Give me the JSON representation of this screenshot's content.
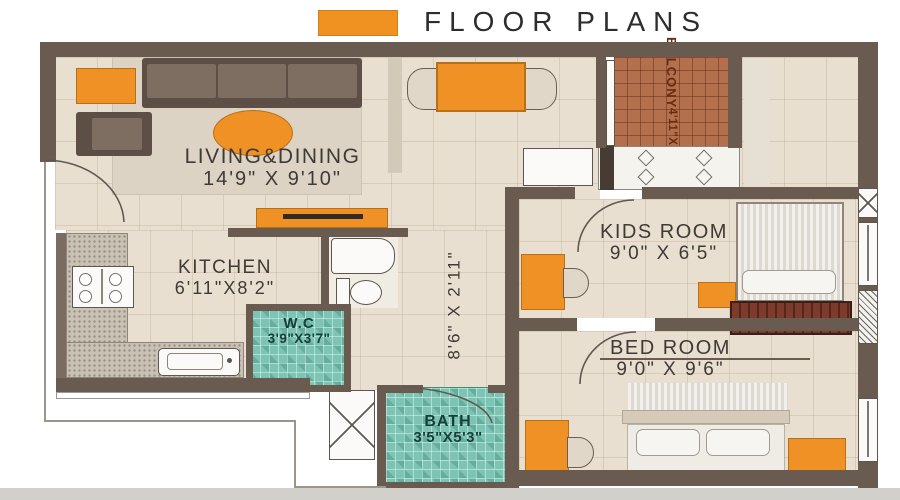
{
  "header": {
    "title": "FLOOR PLANS"
  },
  "legend": {
    "swatch_color": "#F09222"
  },
  "rooms": {
    "living_dining": {
      "name": "LIVING&DINING",
      "dims": "14'9\" X 9'10\""
    },
    "kitchen": {
      "name": "KITCHEN",
      "dims": "6'11\"X8'2\""
    },
    "wc": {
      "name": "W.C",
      "dims": "3'9\"X3'7\""
    },
    "bath": {
      "name": "BATH",
      "dims": "3'5\"X5'3\""
    },
    "kids_room": {
      "name": "KIDS ROOM",
      "dims": "9'0\" X 6'5\""
    },
    "bed_room": {
      "name": "BED ROOM",
      "dims": "9'0\" X 9'6\""
    },
    "balcony": {
      "name": "BALCONY",
      "dims": "4'11\"X3'0\""
    },
    "passage": {
      "dims": "8'6\" X 2'11\""
    }
  },
  "palette": {
    "wall": "#6A5B51",
    "floor": "#E9DFD0",
    "accent_orange": "#EF9125",
    "bath_tile": "#7CC5B4",
    "balcony_tile": "#B4704D",
    "wardrobe": "#6C3227"
  },
  "icons": {
    "stove_burner": "circle-glyph",
    "hob_burner": "diamond-glyph",
    "window_cross": "x-glyph"
  }
}
